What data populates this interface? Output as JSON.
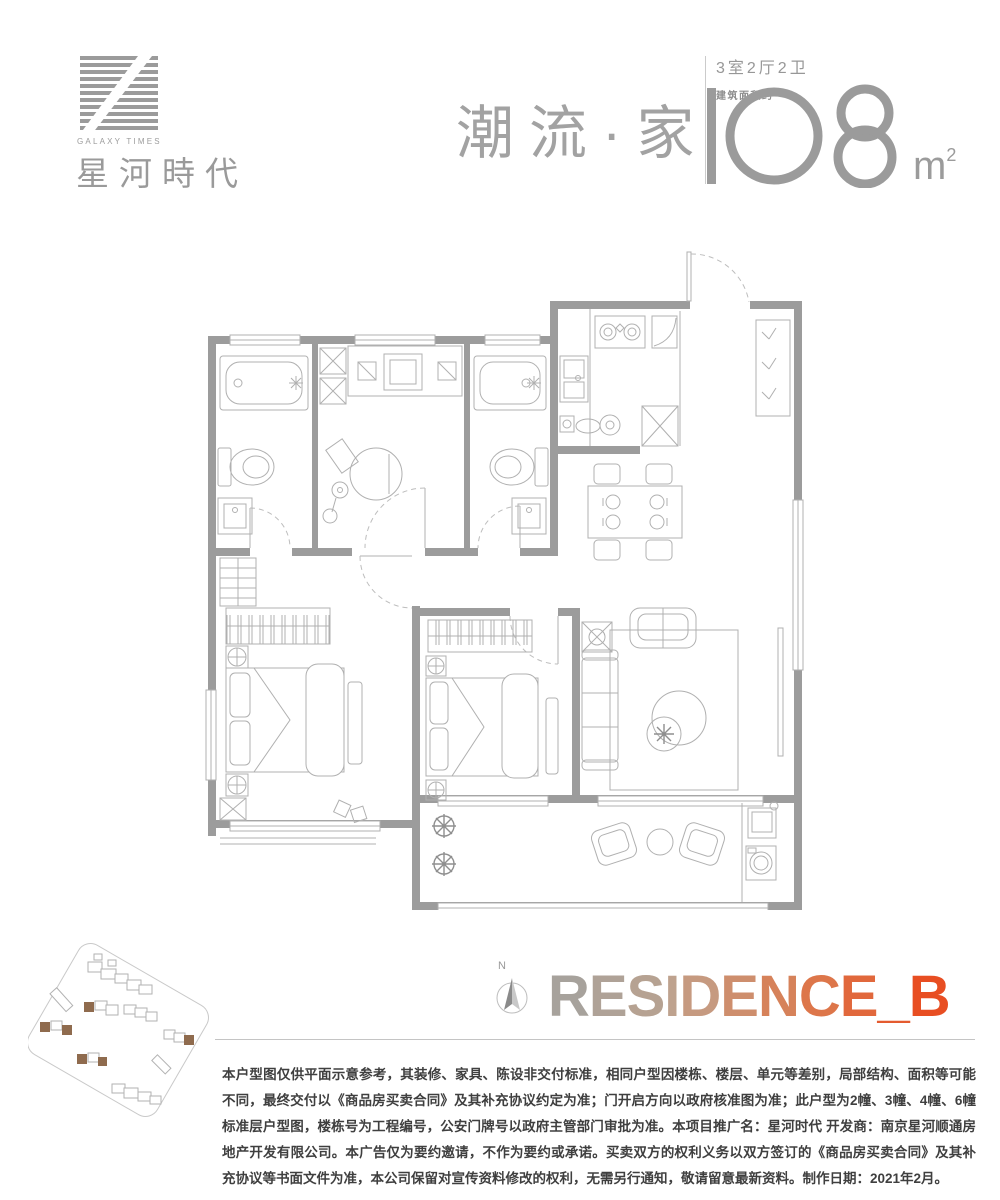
{
  "brand": {
    "name_en": "GALAXY TIMES",
    "name_cn": "星河時代"
  },
  "header": {
    "slogan": "潮流·家",
    "spec_rooms": "3室2厅2卫",
    "area_label": "建筑面积约",
    "area_value": "108",
    "area_unit": "m",
    "area_exp": "2"
  },
  "residence": {
    "compass_label": "N",
    "name": "RESIDENCE_B",
    "gradient": [
      "#a7a29c",
      "#c0a28c",
      "#dc7a4e",
      "#e84e22"
    ]
  },
  "siteplan": {
    "highlight_color": "#8f6b4e"
  },
  "floorplan": {
    "wall_color": "#9c9c9c",
    "line_color": "#b0b0b0"
  },
  "disclaimer": "本户型图仅供平面示意参考，其装修、家具、陈设非交付标准，相同户型因楼栋、楼层、单元等差别，局部结构、面积等可能不同，最终交付以《商品房买卖合同》及其补充协议约定为准；门开启方向以政府核准图为准；此户型为2幢、3幢、4幢、6幢标准层户型图，楼栋号为工程编号，公安门牌号以政府主管部门审批为准。本项目推广名：星河时代 开发商：南京星河顺通房地产开发有限公司。本广告仅为要约邀请，不作为要约或承诺。买卖双方的权利义务以双方签订的《商品房买卖合同》及其补充协议等书面文件为准，本公司保留对宣传资料修改的权利，无需另行通知，敬请留意最新资料。制作日期：2021年2月。"
}
